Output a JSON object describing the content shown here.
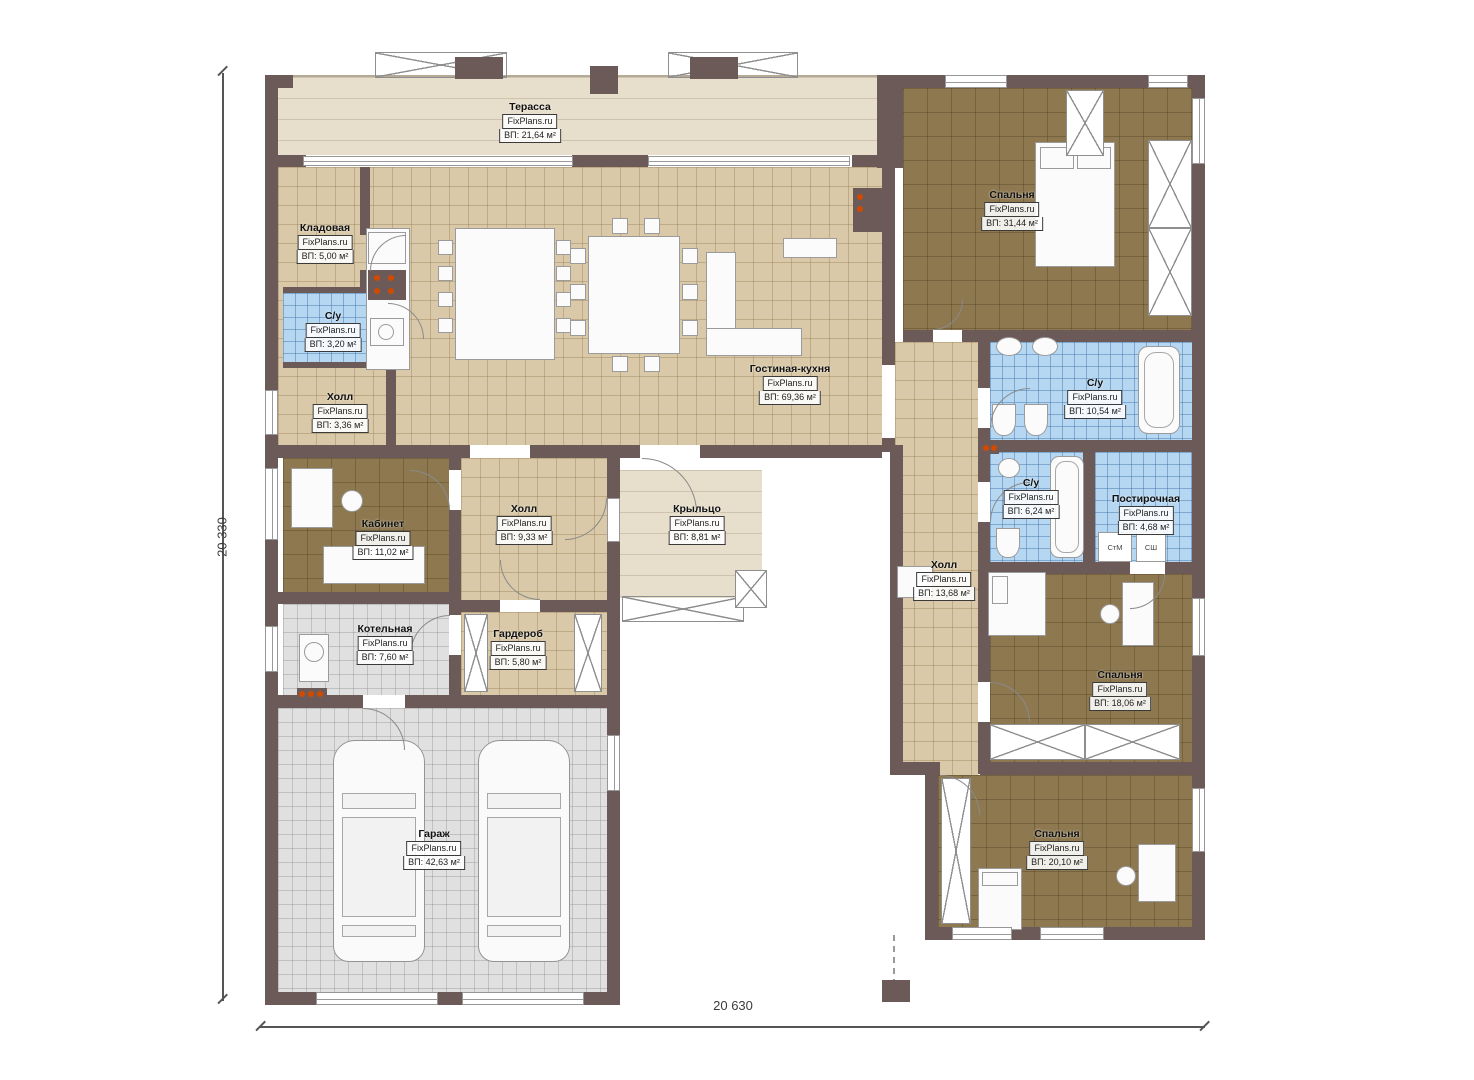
{
  "site_watermark": "FixPlans.ru",
  "dimensions": {
    "left": "20 330",
    "bottom": "20 630"
  },
  "rooms": [
    {
      "id": "terrace",
      "name": "Терасса",
      "watermark": "FixPlans.ru",
      "area": "ВП: 21,64 м²"
    },
    {
      "id": "storage",
      "name": "Кладовая",
      "watermark": "FixPlans.ru",
      "area": "ВП: 5,00 м²"
    },
    {
      "id": "bathroom-1",
      "name": "С/у",
      "watermark": "FixPlans.ru",
      "area": "ВП: 3,20 м²"
    },
    {
      "id": "hall-1",
      "name": "Холл",
      "watermark": "FixPlans.ru",
      "area": "ВП: 3,36 м²"
    },
    {
      "id": "living-kitchen",
      "name": "Гостиная-кухня",
      "watermark": "FixPlans.ru",
      "area": "ВП: 69,36 м²"
    },
    {
      "id": "bedroom-1",
      "name": "Спальня",
      "watermark": "FixPlans.ru",
      "area": "ВП: 31,44 м²"
    },
    {
      "id": "bathroom-2",
      "name": "С/у",
      "watermark": "FixPlans.ru",
      "area": "ВП: 10,54 м²"
    },
    {
      "id": "bathroom-3",
      "name": "С/у",
      "watermark": "FixPlans.ru",
      "area": "ВП: 6,24 м²"
    },
    {
      "id": "laundry",
      "name": "Постирочная",
      "watermark": "FixPlans.ru",
      "area": "ВП: 4,68 м²"
    },
    {
      "id": "hall-2",
      "name": "Холл",
      "watermark": "FixPlans.ru",
      "area": "ВП: 13,68 м²"
    },
    {
      "id": "bedroom-2",
      "name": "Спальня",
      "watermark": "FixPlans.ru",
      "area": "ВП: 18,06 м²"
    },
    {
      "id": "bedroom-3",
      "name": "Спальня",
      "watermark": "FixPlans.ru",
      "area": "ВП: 20,10 м²"
    },
    {
      "id": "office",
      "name": "Кабинет",
      "watermark": "FixPlans.ru",
      "area": "ВП: 11,02 м²"
    },
    {
      "id": "hall-3",
      "name": "Холл",
      "watermark": "FixPlans.ru",
      "area": "ВП: 9,33 м²"
    },
    {
      "id": "porch",
      "name": "Крыльцо",
      "watermark": "FixPlans.ru",
      "area": "ВП: 8,81 м²"
    },
    {
      "id": "boiler",
      "name": "Котельная",
      "watermark": "FixPlans.ru",
      "area": "ВП: 7,60 м²"
    },
    {
      "id": "wardrobe",
      "name": "Гардероб",
      "watermark": "FixPlans.ru",
      "area": "ВП: 5,80 м²"
    },
    {
      "id": "garage",
      "name": "Гараж",
      "watermark": "FixPlans.ru",
      "area": "ВП: 42,63 м²"
    }
  ],
  "appliances": {
    "washer": "СтМ",
    "dryer": "СШ"
  },
  "colors": {
    "wall": "#6b5a58",
    "tan": "#d9c9a8",
    "brown": "#8d7850",
    "blue": "#b6d7f2",
    "gray": "#e0e0e0",
    "beige": "#e7decb",
    "dots": "#d24a00"
  }
}
